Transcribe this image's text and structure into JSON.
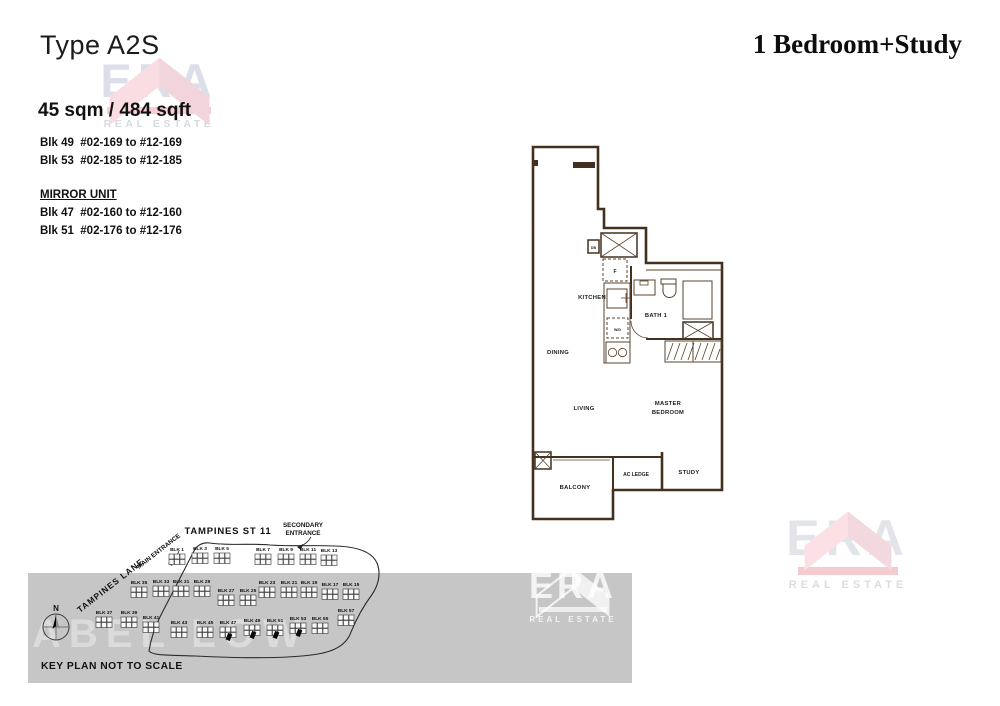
{
  "header": {
    "type_label": "Type A2S",
    "bedroom_label": "1 Bedroom+Study"
  },
  "info": {
    "area": "45 sqm / 484 sqft",
    "block_ranges": [
      "Blk 49  #02-169 to #12-169",
      "Blk 53  #02-185 to #12-185"
    ],
    "mirror_title": "MIRROR UNIT",
    "mirror_block_ranges": [
      "Blk 47  #02-160 to #12-160",
      "Blk 51  #02-176 to #12-176"
    ]
  },
  "floorplan": {
    "fill_color": "#F6C79F",
    "wall_color": "#43301E",
    "labels": {
      "kitchen": "KITCHEN",
      "dining": "DINING",
      "living": "LIVING",
      "master_line1": "MASTER",
      "master_line2": "BEDROOM",
      "bath": "BATH 1",
      "balcony": "BALCONY",
      "ac_ledge": "AC LEDGE",
      "study": "STUDY",
      "db": "DB",
      "fridge": "F",
      "washer": "W/D"
    }
  },
  "keyplan": {
    "note": "KEY PLAN NOT TO SCALE",
    "compass": "N",
    "watermark": "ABEL LOW",
    "roads": {
      "street": "TAMPINES ST 11",
      "lane": "TAMPINES LANE",
      "main": "MAIN ENTRANCE",
      "secondary_1": "SECONDARY",
      "secondary_2": "ENTRANCE"
    },
    "highlight_blocks": [
      "BLK 47",
      "BLK 49",
      "BLK 51",
      "BLK 53"
    ],
    "blocks": [
      {
        "label": "BLK 1",
        "x": 177,
        "y": 551
      },
      {
        "label": "BLK 3",
        "x": 200,
        "y": 550
      },
      {
        "label": "BLK 5",
        "x": 222,
        "y": 550
      },
      {
        "label": "BLK 7",
        "x": 263,
        "y": 551
      },
      {
        "label": "BLK 9",
        "x": 286,
        "y": 551
      },
      {
        "label": "BLK 11",
        "x": 308,
        "y": 551
      },
      {
        "label": "BLK 13",
        "x": 329,
        "y": 552
      },
      {
        "label": "BLK 35",
        "x": 139,
        "y": 584
      },
      {
        "label": "BLK 33",
        "x": 161,
        "y": 583
      },
      {
        "label": "BLK 31",
        "x": 181,
        "y": 583
      },
      {
        "label": "BLK 29",
        "x": 202,
        "y": 583
      },
      {
        "label": "BLK 27",
        "x": 226,
        "y": 592
      },
      {
        "label": "BLK 25",
        "x": 248,
        "y": 592
      },
      {
        "label": "BLK 23",
        "x": 267,
        "y": 584
      },
      {
        "label": "BLK 21",
        "x": 289,
        "y": 584
      },
      {
        "label": "BLK 19",
        "x": 309,
        "y": 584
      },
      {
        "label": "BLK 17",
        "x": 330,
        "y": 586
      },
      {
        "label": "BLK 15",
        "x": 351,
        "y": 586
      },
      {
        "label": "BLK 37",
        "x": 104,
        "y": 614
      },
      {
        "label": "BLK 39",
        "x": 129,
        "y": 614
      },
      {
        "label": "BLK 41",
        "x": 151,
        "y": 619
      },
      {
        "label": "BLK 43",
        "x": 179,
        "y": 624
      },
      {
        "label": "BLK 45",
        "x": 205,
        "y": 624
      },
      {
        "label": "BLK 47",
        "x": 228,
        "y": 624,
        "hl": true
      },
      {
        "label": "BLK 49",
        "x": 252,
        "y": 622,
        "hl": true
      },
      {
        "label": "BLK 51",
        "x": 275,
        "y": 622,
        "hl": true
      },
      {
        "label": "BLK 53",
        "x": 298,
        "y": 620,
        "hl": true
      },
      {
        "label": "BLK 55",
        "x": 320,
        "y": 620
      },
      {
        "label": "BLK 57",
        "x": 346,
        "y": 612
      }
    ]
  },
  "branding": {
    "era": "ERA",
    "real_estate": "REAL ESTATE",
    "logo_pink_light": "#FADDE2",
    "logo_pink_dark": "#F2D5DC",
    "logo_red_bar": "#F6CCD3",
    "logo_letter_gray": "#DBDFE9"
  }
}
